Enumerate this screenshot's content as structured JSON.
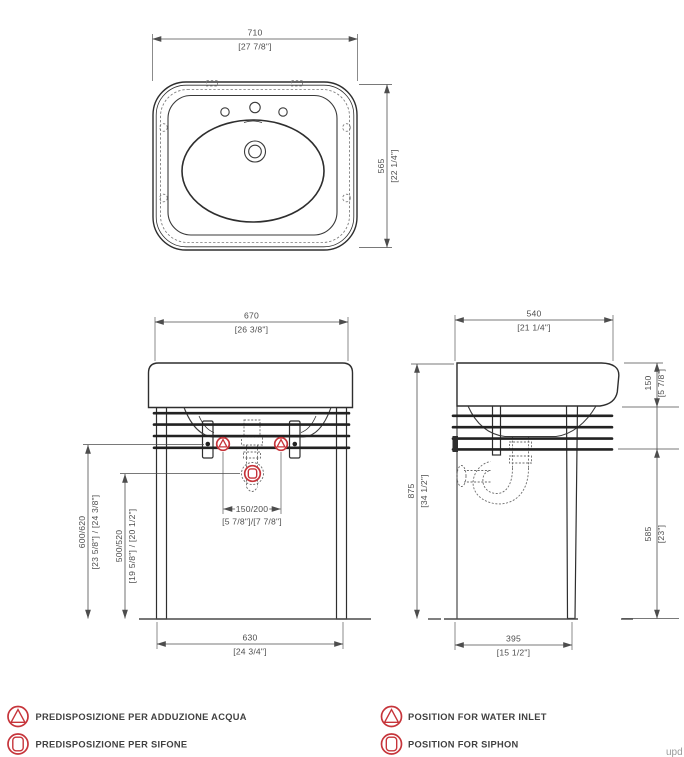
{
  "dims": {
    "d710": {
      "mm": "710",
      "in": "[27 7/8\"]"
    },
    "d565": {
      "mm": "565",
      "in": "[22 1/4\"]"
    },
    "d670": {
      "mm": "670",
      "in": "[26 3/8\"]"
    },
    "d630": {
      "mm": "630",
      "in": "[24 3/4\"]"
    },
    "d600620": {
      "mm": "600/620",
      "in": "[23 5/8\"] / [24 3/8\"]"
    },
    "d500520": {
      "mm": "500/520",
      "in": "[19 5/8\"] / [20 1/2\"]"
    },
    "d150200": {
      "mm": "150/200",
      "in": "[5 7/8\"]/[7 7/8\"]"
    },
    "d540": {
      "mm": "540",
      "in": "[21 1/4\"]"
    },
    "d395": {
      "mm": "395",
      "in": "[15 1/2\"]"
    },
    "d875": {
      "mm": "875",
      "in": "[34 1/2\"]"
    },
    "d150": {
      "mm": "150",
      "in": "[5 7/8\"]"
    },
    "d585": {
      "mm": "585",
      "in": "[23\"]"
    }
  },
  "legend": {
    "it": [
      {
        "label": "PREDISPOSIZIONE PER ADDUZIONE ACQUA"
      },
      {
        "label": "PREDISPOSIZIONE PER SIFONE"
      }
    ],
    "en": [
      {
        "label": "POSITION FOR WATER INLET"
      },
      {
        "label": "POSITION FOR SIPHON"
      }
    ]
  },
  "watermark": "upd",
  "colors": {
    "accent_red": "#c6343a",
    "line": "#2e2e2e",
    "dim_gray": "#4d4d4d"
  }
}
